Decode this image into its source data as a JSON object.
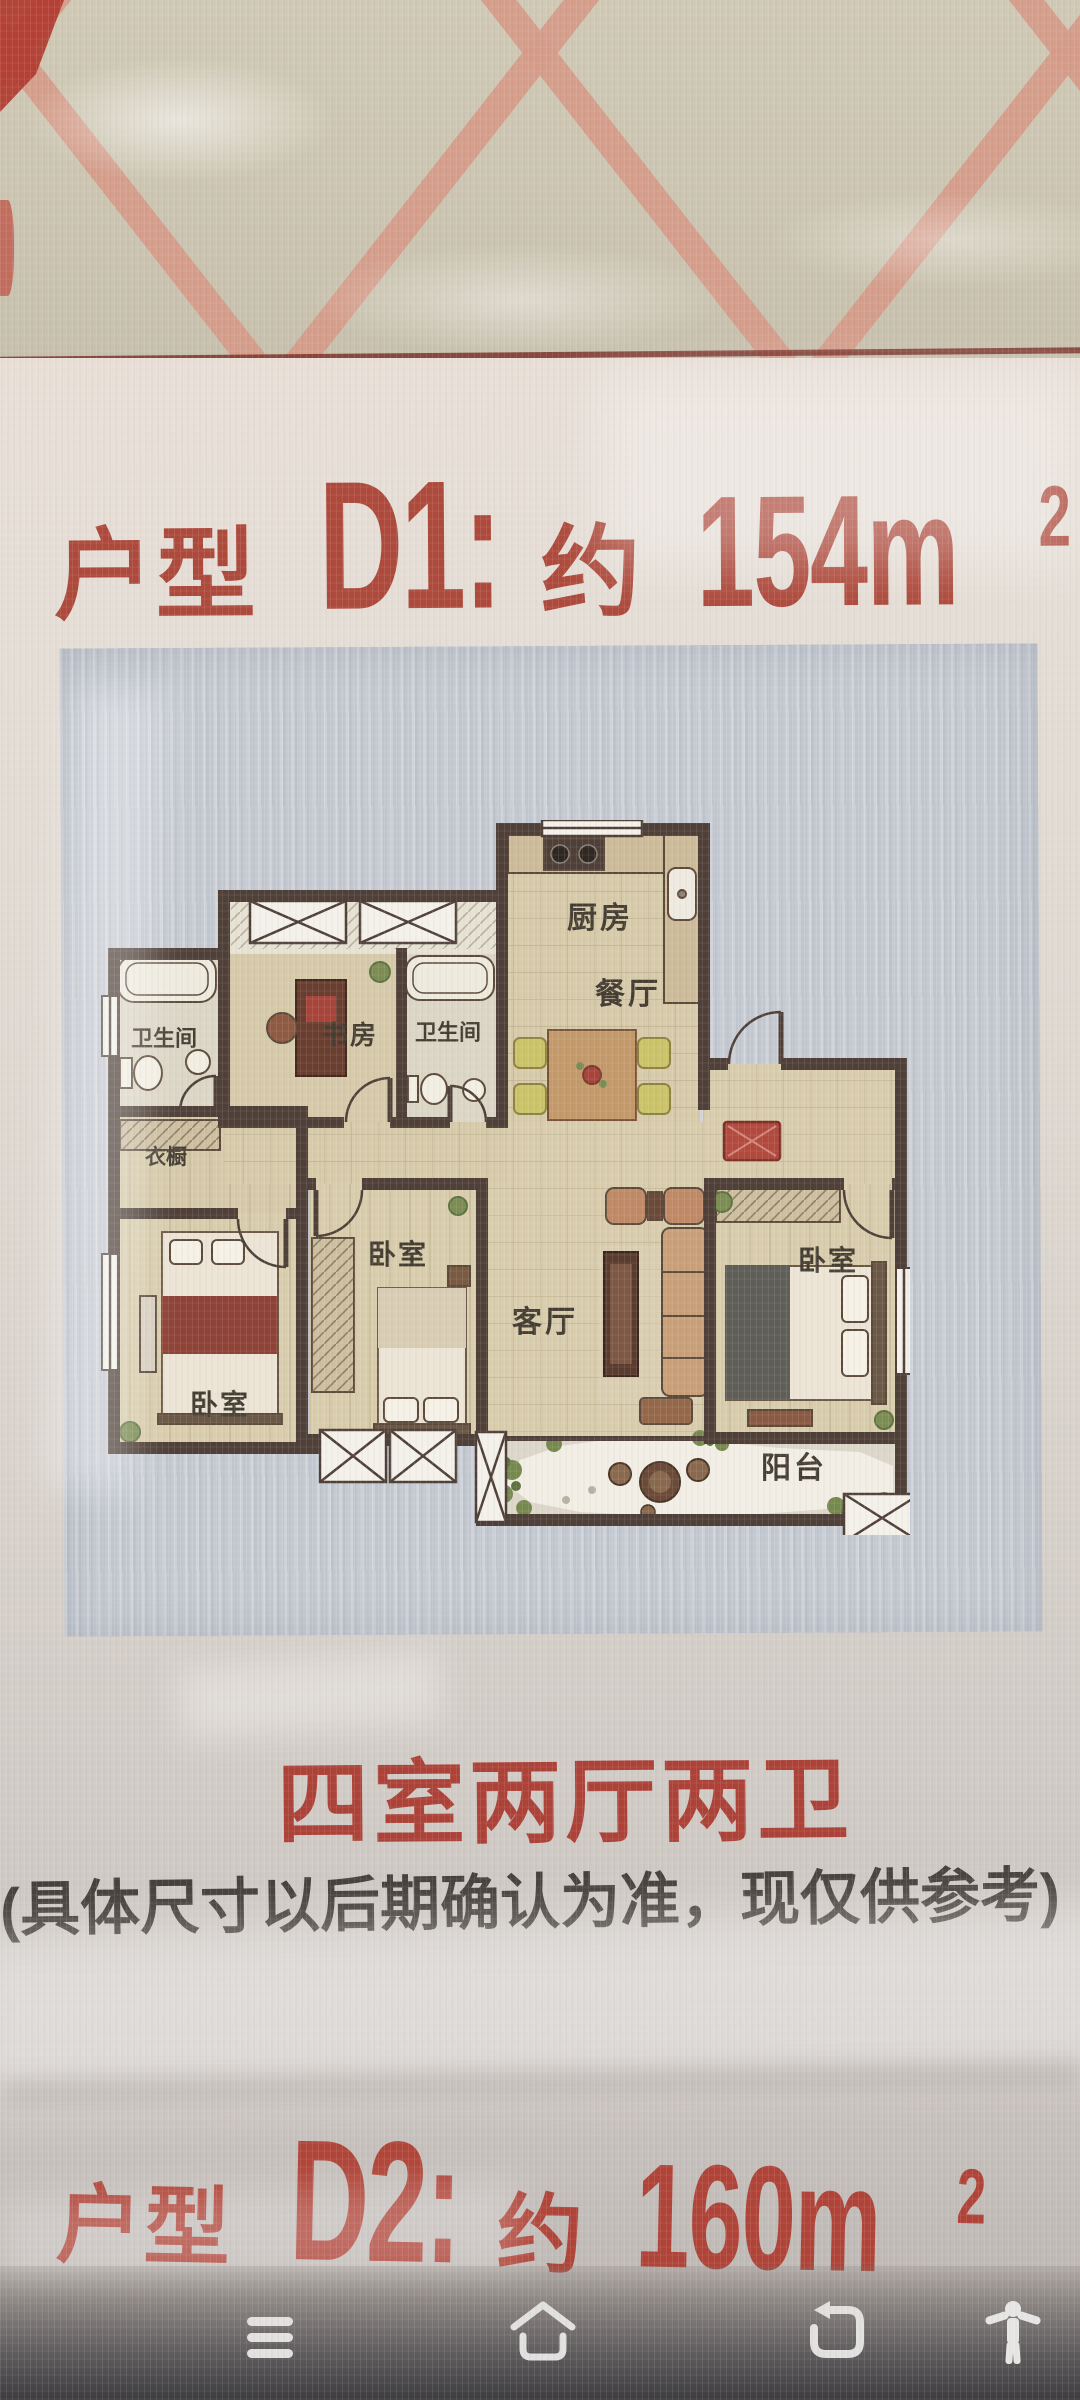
{
  "poster": {
    "unit_d1": {
      "prefix": "户型",
      "code": "D1:",
      "approx": "约",
      "area": "154m",
      "sup": "2"
    },
    "unit_d2": {
      "prefix": "户型",
      "code": "D2:",
      "approx": "约",
      "area": "160m",
      "sup": "2"
    },
    "summary": "四室两厅两卫",
    "disclaimer": "(具体尺寸以后期确认为准，现仅供参考)"
  },
  "floorplan": {
    "labels": {
      "kitchen": "厨房",
      "dining": "餐厅",
      "living": "客厅",
      "balcony": "阳台",
      "bedroom": "卧室",
      "bathroom": "卫生间",
      "study": "书房",
      "closet": "衣橱"
    }
  },
  "navbar": {
    "icons": [
      "menu",
      "home",
      "back",
      "accessibility"
    ]
  },
  "colors": {
    "title_red": "#ae4a3c",
    "summary_red": "#ad4238",
    "disclaimer_gray": "#45403b",
    "panel_blue": "#c5c9d1",
    "wall_brown": "#4f4038",
    "lattice_pink": "#d69c89",
    "patch_red": "#b23a2f"
  }
}
